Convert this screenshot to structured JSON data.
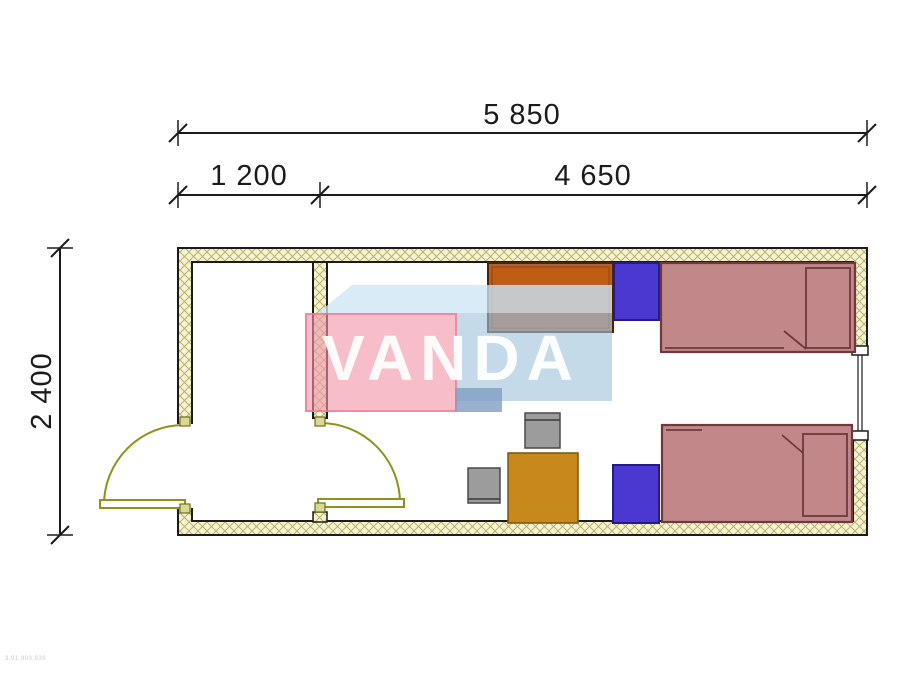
{
  "drawing": {
    "type": "floor-plan",
    "dimensions": {
      "total_width": "5 850",
      "left_room_width": "1 200",
      "main_room_width": "4 650",
      "depth": "2 400"
    },
    "watermark_text": "VANDA",
    "corner_code": "3.91.903.939",
    "colors": {
      "wall_hatch_background": "#f5f2d6",
      "wall_hatch_line": "#b9b465",
      "door_swing": "#8f9119",
      "bed_fill": "#c18789",
      "bed_outline": "#6e383c",
      "locker_fill": "#4b38d1",
      "wardrobe_fill": "#ad6239",
      "wardrobe_top": "#c05d12",
      "table_fill": "#c8891c",
      "chair_fill": "#9c9c9c",
      "watermark_pink": "#f296aa",
      "watermark_blue_light": "#cde6f4",
      "watermark_blue": "#a0c3dc",
      "dimension_ink": "#1b1b1b"
    }
  }
}
